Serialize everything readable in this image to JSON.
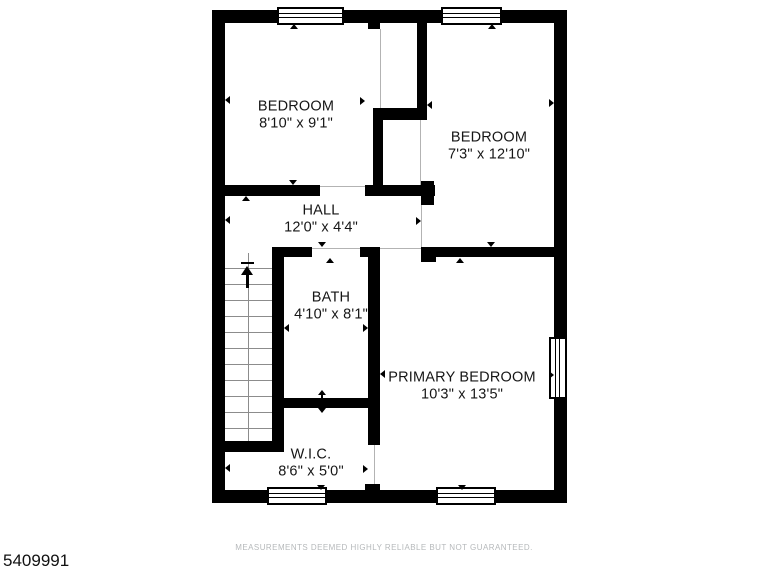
{
  "floorplan": {
    "rooms": [
      {
        "name": "BEDROOM",
        "dims": "8'10\" x 9'1\""
      },
      {
        "name": "BEDROOM",
        "dims": "7'3\" x 12'10\""
      },
      {
        "name": "HALL",
        "dims": "12'0\" x 4'4\""
      },
      {
        "name": "BATH",
        "dims": "4'10\" x 8'1\""
      },
      {
        "name": "PRIMARY BEDROOM",
        "dims": "10'3\" x 13'5\""
      },
      {
        "name": "W.I.C.",
        "dims": "8'6\" x 5'0\""
      }
    ],
    "stairs": {
      "direction": "up",
      "treads": 11
    },
    "window_count": 5,
    "colors": {
      "wall": "#000000",
      "background": "#ffffff",
      "stair_lines": "#8c8c8c",
      "disclaimer_text": "#b6b9bb"
    }
  },
  "footer": {
    "listing_id": "5409991",
    "disclaimer": "MEASUREMENTS DEEMED HIGHLY RELIABLE BUT NOT GUARANTEED."
  }
}
